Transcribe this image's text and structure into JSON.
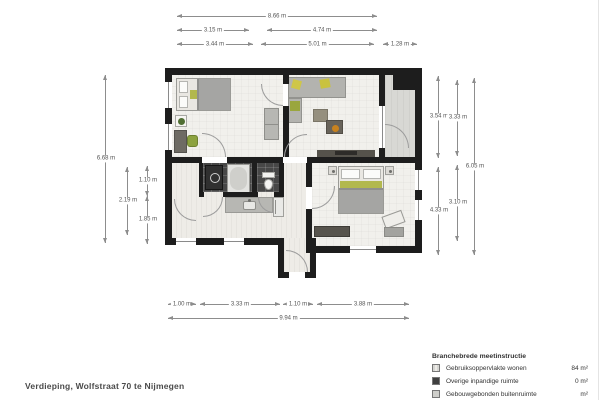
{
  "page": {
    "title": "Verdieping, Wolfstraat 70 te Nijmegen"
  },
  "dims": {
    "top_total": "8.66 m",
    "top_a": "3.15 m",
    "top_b": "4.74 m",
    "top_c": "3.44 m",
    "top_d": "5.01 m",
    "top_e": "1.28 m",
    "left_total": "6.68 m",
    "left_a": "2.19 m",
    "left_b": "1.10 m",
    "left_c": "1.85 m",
    "right_a": "3.54 m",
    "right_b": "4.33 m",
    "right_c": "3.33 m",
    "right_d": "3.10 m",
    "right_total": "6.05 m",
    "bottom_a": "1.00 m",
    "bottom_b": "3.33 m",
    "bottom_c": "1.10 m",
    "bottom_d": "3.88 m",
    "bottom_total": "9.94 m"
  },
  "legend": {
    "header": "Branchebrede meetinstructie",
    "rows": [
      {
        "label": "Gebruiksoppervlakte wonen",
        "value": "84 m²"
      },
      {
        "label": "Overige inpandige ruimte",
        "value": "0 m²"
      },
      {
        "label": "Gebouwgebonden buitenruimte",
        "value": "m²"
      }
    ]
  },
  "colors": {
    "wall": "#1d1d1d",
    "floor": "#f1f0ec",
    "balcony_floor": "#d8d8d4",
    "tile_dark": "#474747",
    "accent_yellow": "#cfc648",
    "accent_green": "#8ca23f",
    "dim_line": "#8d8d8d"
  }
}
